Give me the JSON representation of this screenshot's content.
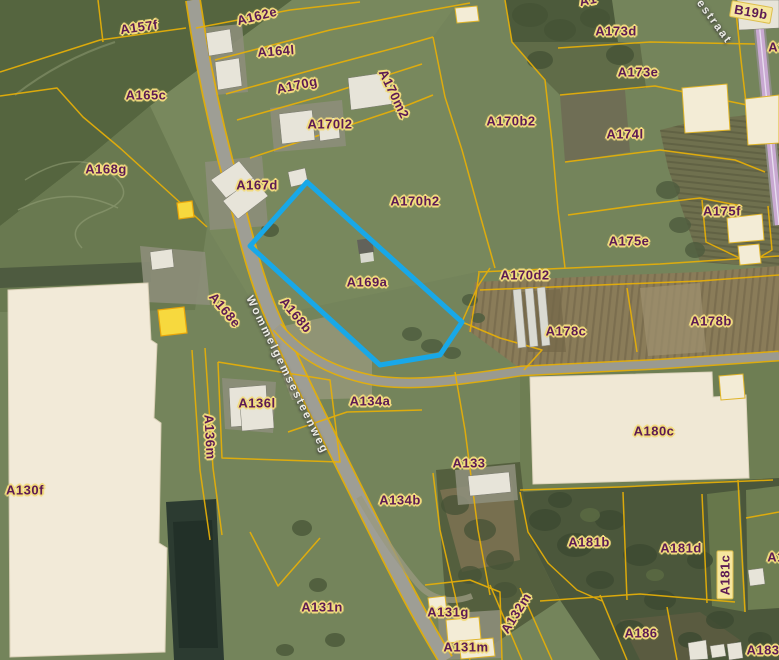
{
  "map": {
    "highlighted_parcel": {
      "id": "A169a",
      "outline_points": "307,182 462,322 440,355 380,365 250,246"
    },
    "colors": {
      "parcel_line": "#E8B007",
      "highlight_outline": "#18A8E8",
      "label_text": "#5C1A54",
      "label_halo": "#F2DB7E",
      "secondary_road": "#C9A9D2"
    },
    "street_labels": [
      {
        "text": "Wommelgemsesteenweg",
        "x": 287,
        "y": 375,
        "rot": 64
      },
      {
        "text": "estraat",
        "x": 714,
        "y": 22,
        "rot": 54
      }
    ],
    "parcel_labels": [
      {
        "text": "A157f",
        "x": 139,
        "y": 27,
        "rot": -8
      },
      {
        "text": "A162e",
        "x": 257,
        "y": 16,
        "rot": -14
      },
      {
        "text": "A164l",
        "x": 276,
        "y": 51,
        "rot": -4
      },
      {
        "text": "A165c",
        "x": 146,
        "y": 95,
        "rot": 0
      },
      {
        "text": "A170g",
        "x": 297,
        "y": 85,
        "rot": -12
      },
      {
        "text": "A170m2",
        "x": 394,
        "y": 94,
        "rot": 64
      },
      {
        "text": "A170l2",
        "x": 330,
        "y": 124,
        "rot": 0
      },
      {
        "text": "A170b2",
        "x": 511,
        "y": 121,
        "rot": 0
      },
      {
        "text": "A173d",
        "x": 616,
        "y": 31,
        "rot": 0
      },
      {
        "text": "A173e",
        "x": 638,
        "y": 72,
        "rot": 0
      },
      {
        "text": "B19b",
        "x": 751,
        "y": 12,
        "rot": 10,
        "boxed": true
      },
      {
        "text": "A174l",
        "x": 625,
        "y": 134,
        "rot": 0
      },
      {
        "text": "A168g",
        "x": 106,
        "y": 169,
        "rot": 0
      },
      {
        "text": "A167d",
        "x": 257,
        "y": 185,
        "rot": 0
      },
      {
        "text": "A170h2",
        "x": 415,
        "y": 201,
        "rot": 0
      },
      {
        "text": "A175f",
        "x": 722,
        "y": 211,
        "rot": 0
      },
      {
        "text": "A175e",
        "x": 629,
        "y": 241,
        "rot": 0
      },
      {
        "text": "A170d2",
        "x": 525,
        "y": 275,
        "rot": 0
      },
      {
        "text": "A169a",
        "x": 367,
        "y": 282,
        "rot": 0
      },
      {
        "text": "A168e",
        "x": 225,
        "y": 310,
        "rot": 50
      },
      {
        "text": "A168b",
        "x": 296,
        "y": 315,
        "rot": 50
      },
      {
        "text": "A178c",
        "x": 566,
        "y": 331,
        "rot": 0
      },
      {
        "text": "A178b",
        "x": 711,
        "y": 321,
        "rot": 0
      },
      {
        "text": "A136m",
        "x": 210,
        "y": 437,
        "rot": 87
      },
      {
        "text": "A136l",
        "x": 257,
        "y": 403,
        "rot": 0
      },
      {
        "text": "A134a",
        "x": 370,
        "y": 401,
        "rot": 0
      },
      {
        "text": "A130f",
        "x": 25,
        "y": 490,
        "rot": 0
      },
      {
        "text": "A133",
        "x": 469,
        "y": 463,
        "rot": 0
      },
      {
        "text": "A134b",
        "x": 400,
        "y": 500,
        "rot": 0
      },
      {
        "text": "A180c",
        "x": 654,
        "y": 431,
        "rot": 0
      },
      {
        "text": "A181b",
        "x": 589,
        "y": 542,
        "rot": 0
      },
      {
        "text": "A181d",
        "x": 681,
        "y": 548,
        "rot": 0
      },
      {
        "text": "A181c",
        "x": 725,
        "y": 575,
        "rot": -90,
        "boxed": true
      },
      {
        "text": "A186",
        "x": 641,
        "y": 633,
        "rot": 0
      },
      {
        "text": "A183",
        "x": 763,
        "y": 650,
        "rot": 0
      },
      {
        "text": "A131n",
        "x": 322,
        "y": 607,
        "rot": 0
      },
      {
        "text": "A131g",
        "x": 448,
        "y": 612,
        "rot": 0
      },
      {
        "text": "A131m",
        "x": 466,
        "y": 647,
        "rot": 0
      },
      {
        "text": "A132m",
        "x": 516,
        "y": 613,
        "rot": -58
      },
      {
        "text": "A1",
        "x": 588,
        "y": 0,
        "rot": -12
      },
      {
        "text": "A1",
        "x": 777,
        "y": 47,
        "rot": 0
      },
      {
        "text": "A1",
        "x": 776,
        "y": 557,
        "rot": 0
      }
    ]
  }
}
